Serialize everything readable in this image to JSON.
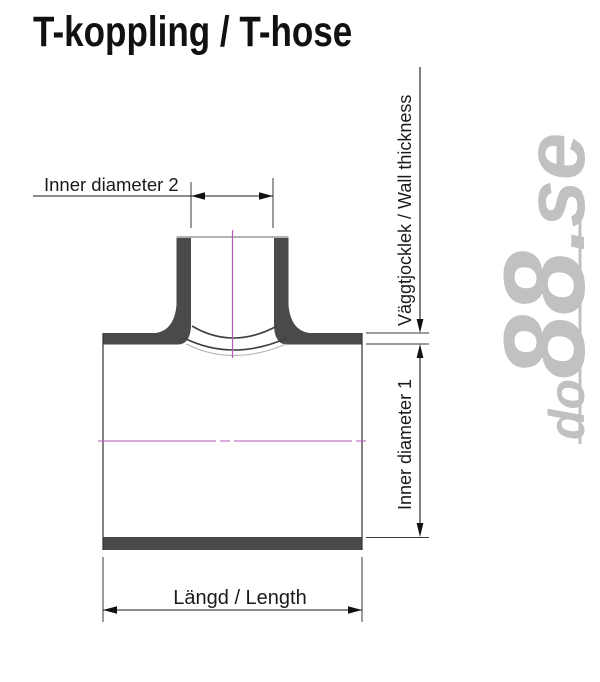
{
  "title": "T-koppling / T-hose",
  "diagram": {
    "labels": {
      "inner_diameter_2": "Inner diameter 2",
      "wall_thickness": "Väggtjocklek / Wall thickness",
      "inner_diameter_1": "Inner diameter 1",
      "length": "Längd / Length"
    },
    "colors": {
      "wall_fill": "#4a4a4a",
      "outline": "#333333",
      "dimension": "#1a1a1a",
      "centerline": "#b55ab5",
      "light_arc": "#b5b5b5",
      "watermark": "#c1c1c1"
    }
  },
  "watermark": {
    "part_do": "do",
    "part_88": "88",
    "part_se": ".se"
  }
}
